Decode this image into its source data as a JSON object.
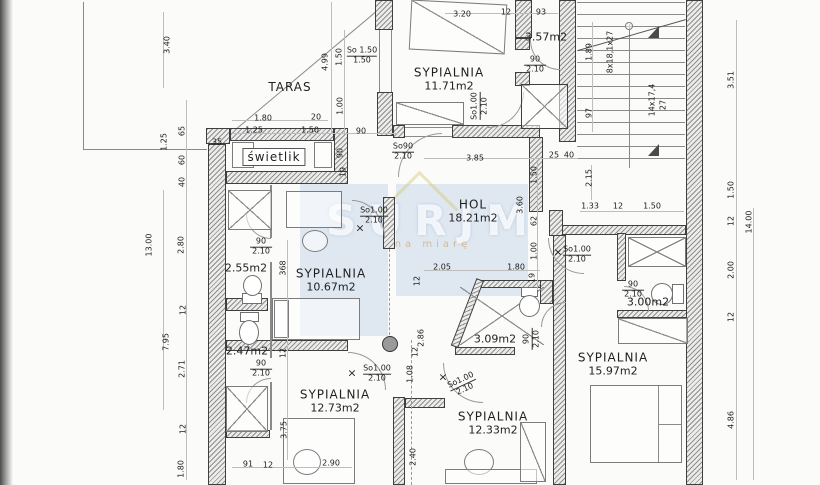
{
  "watermark": {
    "text": "SURJM",
    "tagline": "na miarę"
  },
  "rooms": [
    {
      "name": "TARAS",
      "area": "",
      "x": 290,
      "y": 87
    },
    {
      "name": "SYPIALNIA",
      "area": "11.71m2",
      "x": 449,
      "y": 79
    },
    {
      "name": "",
      "area": "3.57m2",
      "x": 546,
      "y": 37
    },
    {
      "name": "HOL",
      "area": "18.21m2",
      "x": 473,
      "y": 211
    },
    {
      "name": "SYPIALNIA",
      "area": "10.67m2",
      "x": 331,
      "y": 280
    },
    {
      "name": "",
      "area": "2.55m2",
      "x": 246,
      "y": 268
    },
    {
      "name": "",
      "area": "2.47m2",
      "x": 247,
      "y": 351
    },
    {
      "name": "SYPIALNIA",
      "area": "12.73m2",
      "x": 335,
      "y": 401
    },
    {
      "name": "",
      "area": "3.09m2",
      "x": 495,
      "y": 339
    },
    {
      "name": "SYPIALNIA",
      "area": "12.33m2",
      "x": 493,
      "y": 423
    },
    {
      "name": "",
      "area": "3.00m2",
      "x": 648,
      "y": 302
    },
    {
      "name": "SYPIALNIA",
      "area": "15.97m2",
      "x": 613,
      "y": 364
    },
    {
      "name": "świetlik",
      "area": "",
      "x": 274,
      "y": 157,
      "boxed": true
    }
  ],
  "door_labels": [
    {
      "l1": "So 1.50",
      "l2": "1.50",
      "x": 362,
      "y": 56,
      "r": 0
    },
    {
      "l1": "So90",
      "l2": "2.10",
      "x": 403,
      "y": 152,
      "r": 0
    },
    {
      "l1": "90",
      "l2": "2.10",
      "x": 535,
      "y": 65,
      "r": 0
    },
    {
      "l1": "So1.00",
      "l2": "2.10",
      "x": 480,
      "y": 106,
      "r": -90
    },
    {
      "l1": "90",
      "l2": "2.10",
      "x": 261,
      "y": 247,
      "r": 0
    },
    {
      "l1": "90",
      "l2": "2.10",
      "x": 261,
      "y": 369,
      "r": 0
    },
    {
      "l1": "So1.00",
      "l2": "2.10",
      "x": 374,
      "y": 216,
      "r": 0
    },
    {
      "l1": "So1.00",
      "l2": "2.10",
      "x": 377,
      "y": 374,
      "r": 0
    },
    {
      "l1": "So1.00",
      "l2": "2.10",
      "x": 463,
      "y": 385,
      "r": -25
    },
    {
      "l1": "So1.00",
      "l2": "2.10",
      "x": 577,
      "y": 255,
      "r": 0
    },
    {
      "l1": "90",
      "l2": "2.10",
      "x": 633,
      "y": 290,
      "r": 0
    },
    {
      "l1": "90",
      "l2": "2.10",
      "x": 532,
      "y": 339,
      "r": -90
    }
  ],
  "dim_labels": [
    {
      "t": "3.40",
      "x": 167,
      "y": 45,
      "r": -90
    },
    {
      "t": "1.25",
      "x": 164,
      "y": 142,
      "r": -90
    },
    {
      "t": "65",
      "x": 182,
      "y": 131,
      "r": -90
    },
    {
      "t": "60",
      "x": 182,
      "y": 160,
      "r": -90
    },
    {
      "t": "40",
      "x": 182,
      "y": 182,
      "r": -90
    },
    {
      "t": "13.00",
      "x": 149,
      "y": 245,
      "r": -90
    },
    {
      "t": "2.80",
      "x": 181,
      "y": 245,
      "r": -90
    },
    {
      "t": "12",
      "x": 183,
      "y": 310,
      "r": -90
    },
    {
      "t": "7.95",
      "x": 166,
      "y": 342,
      "r": -90
    },
    {
      "t": "2.71",
      "x": 182,
      "y": 369,
      "r": -90
    },
    {
      "t": "12",
      "x": 183,
      "y": 429,
      "r": -90
    },
    {
      "t": "1.80",
      "x": 181,
      "y": 469,
      "r": -90
    },
    {
      "t": "1.80",
      "x": 263,
      "y": 118,
      "r": 0
    },
    {
      "t": "20",
      "x": 316,
      "y": 117,
      "r": 0
    },
    {
      "t": "1.25",
      "x": 254,
      "y": 130,
      "r": 0
    },
    {
      "t": "1.50",
      "x": 310,
      "y": 130,
      "r": 0
    },
    {
      "t": "90",
      "x": 361,
      "y": 131,
      "r": 0
    },
    {
      "t": "35",
      "x": 217,
      "y": 142,
      "r": 0
    },
    {
      "t": "4.99",
      "x": 325,
      "y": 62,
      "r": -90
    },
    {
      "t": "1.50",
      "x": 339,
      "y": 57,
      "r": -90
    },
    {
      "t": "1.00",
      "x": 340,
      "y": 106,
      "r": -90
    },
    {
      "t": "90",
      "x": 340,
      "y": 153,
      "r": -90
    },
    {
      "t": "19",
      "x": 343,
      "y": 172,
      "r": -90
    },
    {
      "t": "3.20",
      "x": 462,
      "y": 14,
      "r": 0
    },
    {
      "t": "12",
      "x": 506,
      "y": 12,
      "r": 0
    },
    {
      "t": "93",
      "x": 541,
      "y": 12,
      "r": 0
    },
    {
      "t": "1.89",
      "x": 589,
      "y": 52,
      "r": -90
    },
    {
      "t": "97",
      "x": 589,
      "y": 113,
      "r": -90
    },
    {
      "t": "3.85",
      "x": 475,
      "y": 158,
      "r": 0
    },
    {
      "t": "25",
      "x": 554,
      "y": 155,
      "r": 0
    },
    {
      "t": "40",
      "x": 569,
      "y": 155,
      "r": 0
    },
    {
      "t": "2.15",
      "x": 589,
      "y": 178,
      "r": -90
    },
    {
      "t": "1.50",
      "x": 534,
      "y": 175,
      "r": -90
    },
    {
      "t": "3.60",
      "x": 520,
      "y": 205,
      "r": -90
    },
    {
      "t": "62",
      "x": 534,
      "y": 221,
      "r": -90
    },
    {
      "t": "1.00",
      "x": 534,
      "y": 251,
      "r": -90
    },
    {
      "t": "1.33",
      "x": 590,
      "y": 206,
      "r": 0
    },
    {
      "t": "12",
      "x": 618,
      "y": 206,
      "r": 0
    },
    {
      "t": "1.50",
      "x": 652,
      "y": 206,
      "r": 0
    },
    {
      "t": "2.05",
      "x": 442,
      "y": 267,
      "r": 0
    },
    {
      "t": "1.80",
      "x": 516,
      "y": 267,
      "r": 0
    },
    {
      "t": "19",
      "x": 532,
      "y": 278,
      "r": -90
    },
    {
      "t": "3.51",
      "x": 731,
      "y": 80,
      "r": -90
    },
    {
      "t": "1.50",
      "x": 731,
      "y": 190,
      "r": -90
    },
    {
      "t": "12",
      "x": 731,
      "y": 221,
      "r": -90
    },
    {
      "t": "14.00",
      "x": 749,
      "y": 222,
      "r": -90
    },
    {
      "t": "2.00",
      "x": 731,
      "y": 270,
      "r": -90
    },
    {
      "t": "12",
      "x": 731,
      "y": 317,
      "r": -90
    },
    {
      "t": "4.86",
      "x": 731,
      "y": 420,
      "r": -90
    },
    {
      "t": "368",
      "x": 283,
      "y": 268,
      "r": -90
    },
    {
      "t": "12",
      "x": 283,
      "y": 353,
      "r": -90
    },
    {
      "t": "3.75",
      "x": 284,
      "y": 430,
      "r": -90
    },
    {
      "t": "91",
      "x": 248,
      "y": 464,
      "r": 0
    },
    {
      "t": "12",
      "x": 268,
      "y": 465,
      "r": 0
    },
    {
      "t": "2.90",
      "x": 331,
      "y": 463,
      "r": 0
    },
    {
      "t": "2.86",
      "x": 421,
      "y": 338,
      "r": -90
    },
    {
      "t": "12",
      "x": 415,
      "y": 352,
      "r": -90
    },
    {
      "t": "1.08",
      "x": 410,
      "y": 374,
      "r": -90
    },
    {
      "t": "2.40",
      "x": 413,
      "y": 457,
      "r": -90
    },
    {
      "t": "12",
      "x": 417,
      "y": 281,
      "r": -90
    }
  ],
  "stair_labels": [
    {
      "t": "8x18,1x27",
      "x": 610,
      "y": 52,
      "r": -90
    },
    {
      "t": "14x17,4",
      "x": 652,
      "y": 100,
      "r": -90
    },
    {
      "t": "27",
      "x": 663,
      "y": 105,
      "r": -90
    }
  ],
  "x_marks": [
    {
      "x": 360,
      "y": 228
    },
    {
      "x": 352,
      "y": 373
    },
    {
      "x": 443,
      "y": 377
    },
    {
      "x": 558,
      "y": 252
    }
  ]
}
